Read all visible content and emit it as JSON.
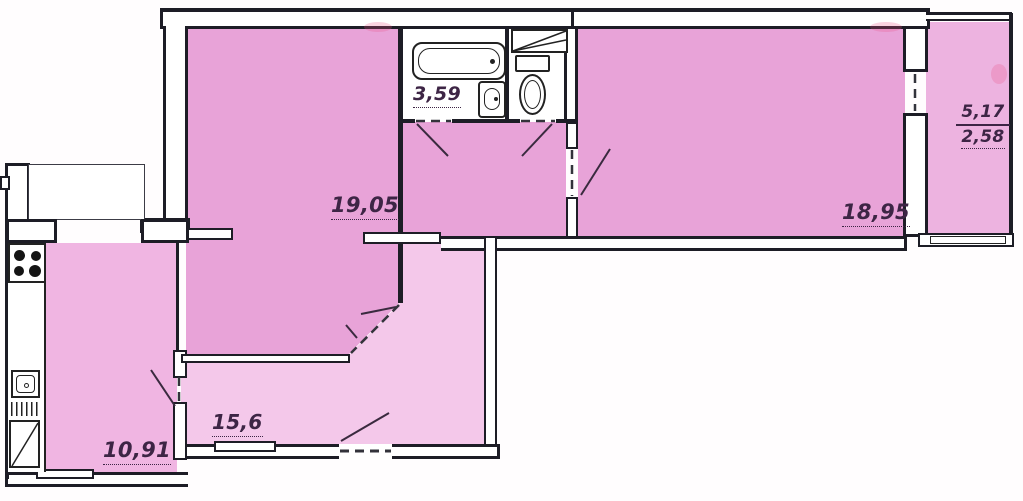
{
  "plan": {
    "type": "apartment-floor-plan",
    "rooms": {
      "bathroom": {
        "label": "3,59"
      },
      "living_room": {
        "label": "19,05"
      },
      "bedroom": {
        "label": "18,95"
      },
      "balcony": {
        "label_total": "5,17",
        "label_reduced": "2,58"
      },
      "kitchen": {
        "label": "10,91"
      },
      "hallway": {
        "label": "15,6"
      }
    },
    "fixtures": [
      "bathtub-icon",
      "washbasin-icon",
      "toilet-icon",
      "vent-shaft-icon",
      "stove-icon",
      "kitchen-sink-icon",
      "drainboard-icon",
      "cabinet-icon"
    ],
    "colors": {
      "room_fill": "#e8a3d8",
      "hall_fill": "#f4c8ea",
      "kitchen_fill": "#f0b5e2",
      "balcony_fill": "#edb3e0",
      "wall": "#1d1d26",
      "label_text": "#3d2545",
      "background": "#ffffff"
    }
  }
}
